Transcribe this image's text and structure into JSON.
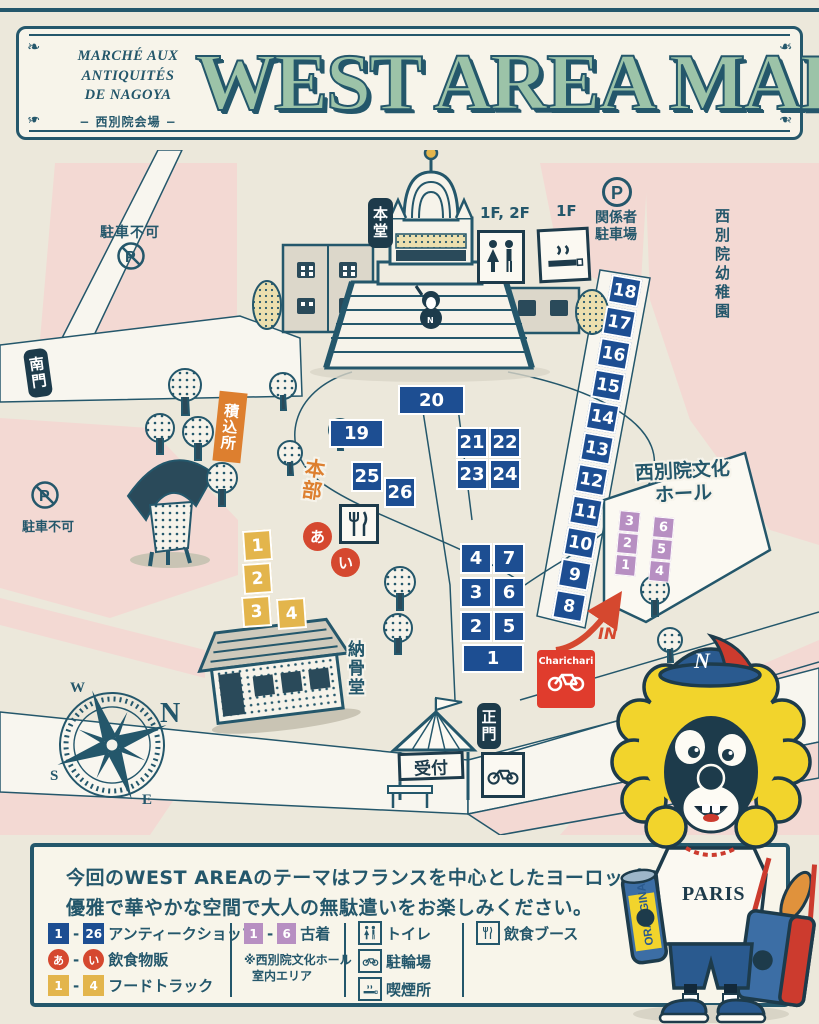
{
  "header": {
    "brand": [
      "MARCHÉ AUX",
      "ANTIQUITÉS",
      "DE NAGOYA"
    ],
    "venue": "− 西別院会場 −",
    "title": "WEST AREA MAP"
  },
  "map": {
    "gates": {
      "south": "南門",
      "main": "正門"
    },
    "buildings": {
      "main_hall": "本堂",
      "ossuary": "納骨堂",
      "culture_hall_l1": "西別院文化",
      "culture_hall_l2": "ホール",
      "kindergarten": "西別院幼稚園"
    },
    "areas": {
      "loading": "積込所",
      "hq": "本部",
      "reception": "受付"
    },
    "parking": {
      "no_parking_1": "駐車不可",
      "no_parking_2": "駐車不可",
      "staff_l1": "関係者",
      "staff_l2": "駐車場",
      "p": "P"
    },
    "floors": {
      "toilet": "1F, 2F",
      "smoking": "1F"
    },
    "in_label": "IN",
    "charichari": "Charichari",
    "compass": {
      "n": "N",
      "e": "E",
      "s": "S",
      "w": "W"
    },
    "booths": {
      "diag": [
        "18",
        "17",
        "16",
        "15",
        "14",
        "13",
        "12",
        "11",
        "10",
        "9",
        "8"
      ],
      "b20": "20",
      "b19": "19",
      "b25": "25",
      "b26": "26",
      "b21": "21",
      "b22": "22",
      "b23": "23",
      "b24": "24",
      "g4": "4",
      "g7": "7",
      "g3": "3",
      "g6": "6",
      "g2": "2",
      "g5": "5",
      "g1": "1"
    },
    "trucks": [
      "1",
      "2",
      "3",
      "4"
    ],
    "stalls": [
      "あ",
      "い"
    ],
    "clothes_left": [
      "3",
      "2",
      "1"
    ],
    "clothes_right": [
      "6",
      "5",
      "4"
    ]
  },
  "mascot": {
    "cap": "N",
    "shirt": "PARIS",
    "can": "ORANGINA"
  },
  "panel": {
    "line1": "今回のWEST AREAのテーマはフランスを中心としたヨーロッパの蚤の市!!",
    "line2": "優雅で華やかな空間で大人の無駄遣いをお楽しみください。",
    "legend": {
      "antique": {
        "a": "1",
        "b": "26",
        "dash": "-",
        "label": "アンティークショップ"
      },
      "stall": {
        "a": "あ",
        "b": "い",
        "dash": "-",
        "label": "飲食物販"
      },
      "truck": {
        "a": "1",
        "b": "4",
        "dash": "-",
        "label": "フードトラック"
      },
      "clothes": {
        "a": "1",
        "b": "6",
        "dash": "-",
        "label": "古着",
        "note1": "※西別院文化ホール",
        "note2": "室内エリア"
      },
      "toilet": "トイレ",
      "bicycle": "駐輪場",
      "smoking": "喫煙所",
      "booth": "飲食ブース"
    }
  },
  "colors": {
    "ink": "#24576b",
    "title_green": "#9cc3a8",
    "booth_blue": "#1d4e92",
    "block_pink": "#f3d9d3",
    "truck_yellow": "#e3b54c",
    "area_orange": "#dd7f2f",
    "stall_red": "#d5482f",
    "clothes_purple": "#b78fc2",
    "paper_cream": "#ece8db"
  }
}
